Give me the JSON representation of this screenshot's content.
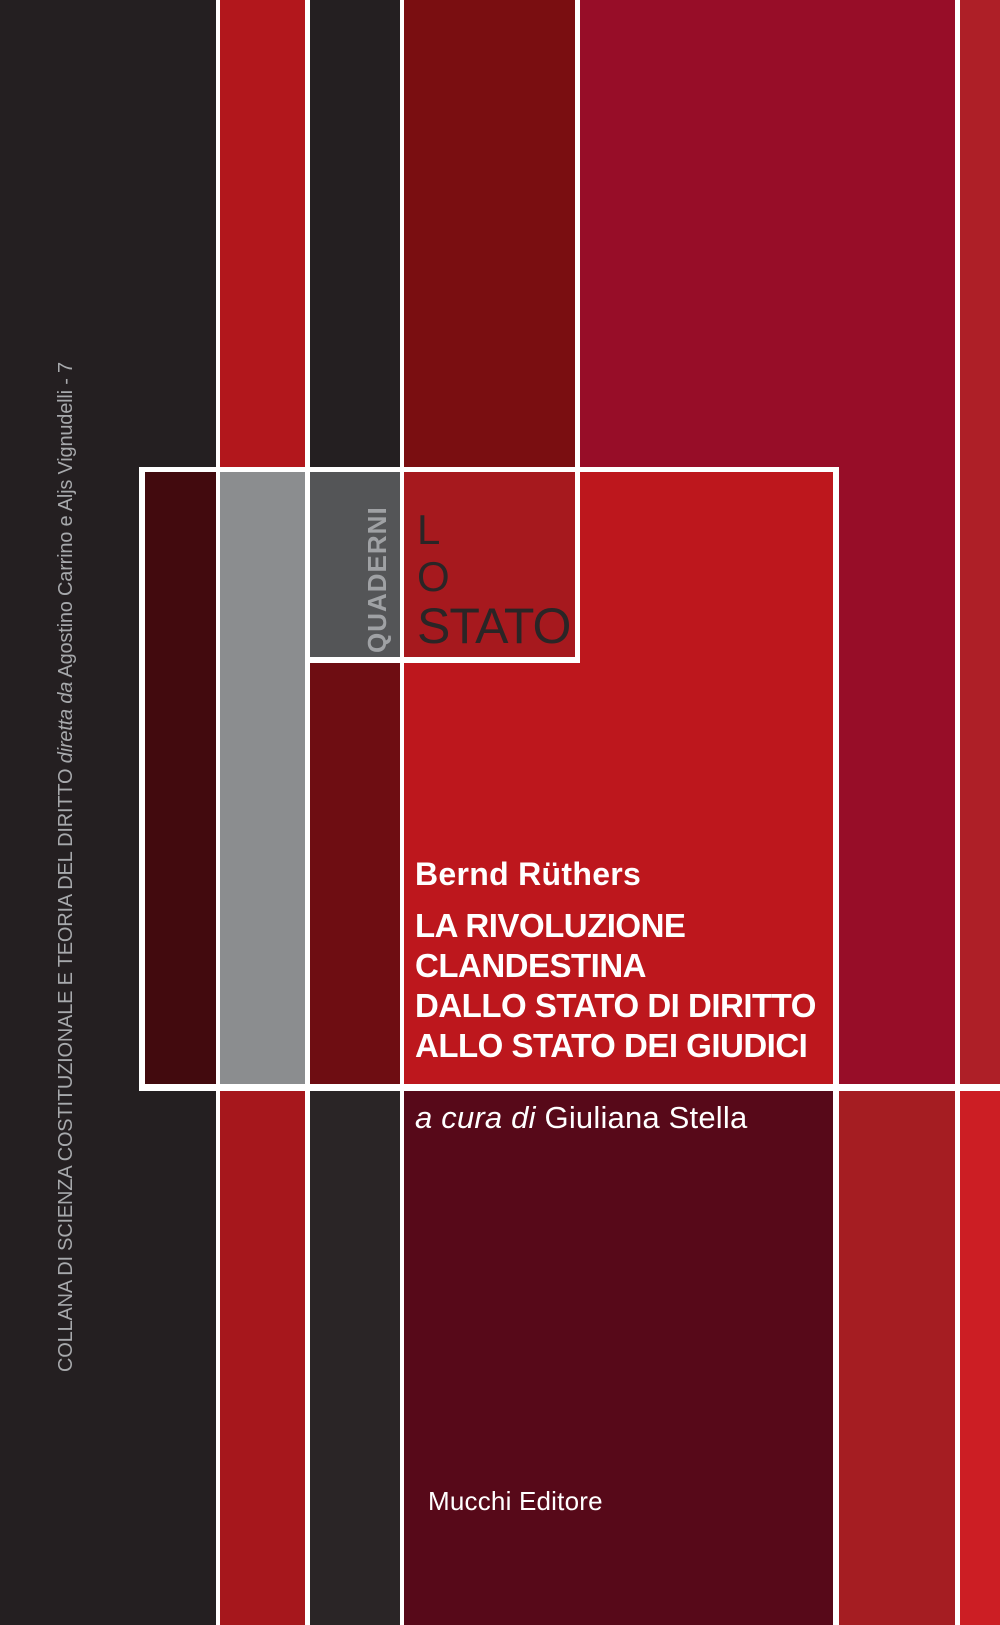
{
  "cover": {
    "series_vertical": {
      "part1": "COLLANA DI SCIENZA COSTITUZIONALE E TEORIA DEL DIRITTO",
      "part2_italic": "diretta da",
      "part3": "Agostino Carrino e Aljs Vignudelli - 7"
    },
    "collection_label": "QUADERNI",
    "logo": {
      "line1": "L",
      "line2": "O",
      "line3": "STATO"
    },
    "author": "Bernd Rüthers",
    "title": {
      "lines": [
        "LA RIVOLUZIONE",
        "CLANDESTINA",
        "DALLO STATO DI DIRITTO",
        "ALLO STATO DEI GIUDICI"
      ]
    },
    "editor": {
      "prefix": "a cura di",
      "name": "Giuliana Stella"
    },
    "publisher": "Mucchi Editore"
  },
  "colors": {
    "ink-dark": "#241f21",
    "ink-dark2": "#2a2526",
    "red-stripe-top": "#b2171c",
    "gray-box": "#8b8d8f",
    "maroon-box": "#420a0e",
    "quaderni-bg": "#545557",
    "quaderni-gray": "#9fa1a4",
    "midcol-darkred": "#6e0d12",
    "red-stripe-bottom": "#a6171c",
    "darkred-top": "#7a0e11",
    "lostato-red": "#a6191e",
    "logo-ink": "#2a2526",
    "crimson": "#970d28",
    "field-red": "#bd171d",
    "maroon-panel": "#570919",
    "right-red-bottom": "#a51d22",
    "band6-red": "#ae1f27",
    "band6-red-bottom": "#cc1e24",
    "collana-gray": "#a7a9ac",
    "divider-white": "#ffffff"
  }
}
